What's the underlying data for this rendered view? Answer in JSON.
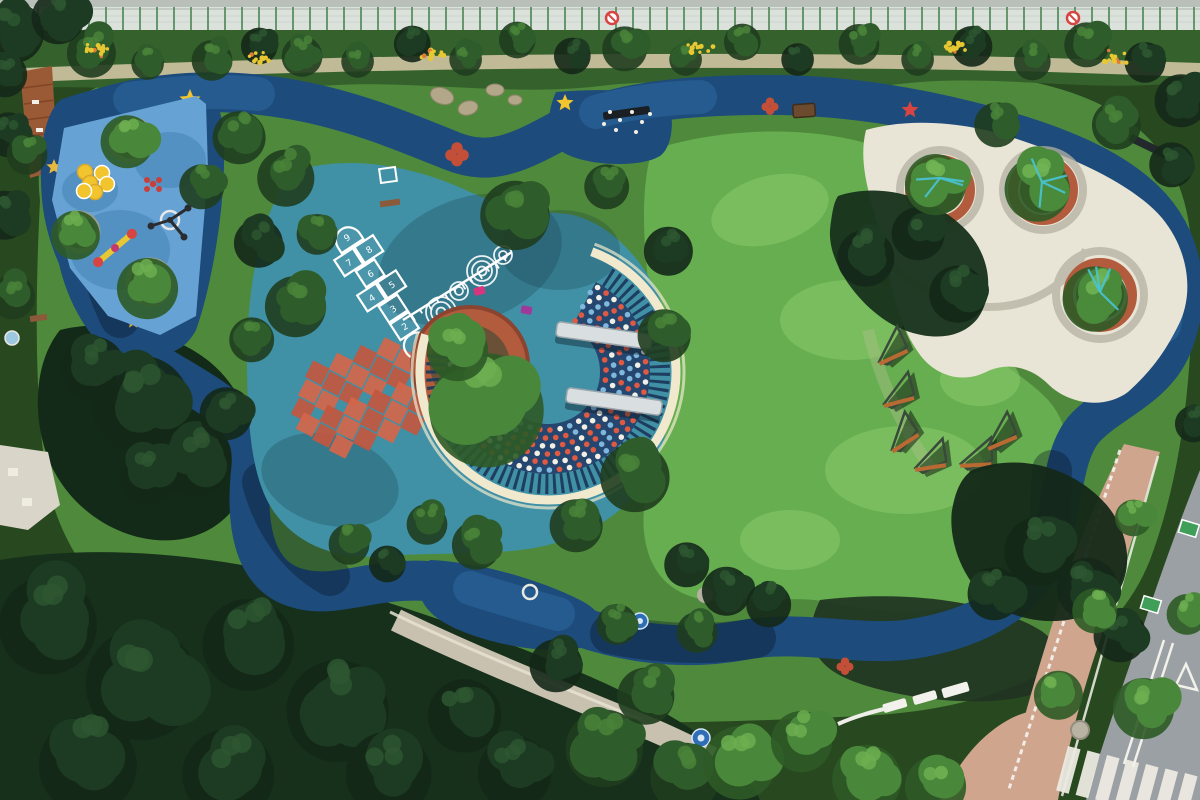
{
  "scene": {
    "title": "Aerial Park View",
    "description": "Top-down drone photograph of a community pocket park: a dark-blue rubber jogging loop winds around a light-blue toddler playground with yellow discs and stars, a teal play plaza with a numbered hopscotch, growth ruler, orange checkerboard and a crescent pergola with confetti dots and two steel benches, a bright lawn with rust zigzag climbers, and a white plaza with round brick tree planters. Dense tree canopy borders the park, a street with zebra crossing crosses the lower-right corner and a construction fence runs along the top."
  },
  "colors": {
    "track": "#1d4b7b",
    "trackLight": "#2f6ca6",
    "navy": "#25476f",
    "playBlue": "#66a3d4",
    "playShadow": "#3f7cb0",
    "teal": "#4090a6",
    "tealShadow": "#2e7390",
    "lawn": "#66ae4f",
    "lawnLight": "#8bcb6b",
    "grass": "#4f8a3c",
    "shrub": "#35622c",
    "parkBase": "#4f8a3c",
    "cream": "#f0e9cd",
    "plaza": "#e9e5d6",
    "plazaBand": "#b6b2a2",
    "brick": "#b25c3d",
    "brickDark": "#8a4430",
    "soil": "#6a5036",
    "sidewalk": "#d0a58e",
    "stone": "#c8c1b0",
    "road": "#9ba0a4",
    "rust": "#b96a33",
    "yellow": "#f2c52e",
    "red": "#d64541",
    "magenta": "#d6367f",
    "tealPaint": "#49c4d6",
    "markGreen": "#3f9e57",
    "wood": "#9a5a36",
    "benchSteel": "#d9dee1",
    "binBrown": "#6b4a2e",
    "checkerA": "#d4664a",
    "checkerB": "#c2573f",
    "fenceLight": "#e3e7e3",
    "fencePost": "#5b8f63",
    "canopyDark": "#142818",
    "canopyMid": "#2f5c2b",
    "canopyBright": "#49873a"
  },
  "hopscotch": {
    "cells": [
      {
        "n": "1",
        "x": 0,
        "y": 62
      },
      {
        "n": "2",
        "x": 0,
        "y": 40
      },
      {
        "n": "3",
        "x": 0,
        "y": 19
      },
      {
        "n": "4",
        "x": -12,
        "y": -2
      },
      {
        "n": "5",
        "x": 12,
        "y": -2
      },
      {
        "n": "6",
        "x": 0,
        "y": -23
      },
      {
        "n": "7",
        "x": -12,
        "y": -44
      },
      {
        "n": "8",
        "x": 12,
        "y": -44
      },
      {
        "n": "9",
        "x": 0,
        "y": -66
      }
    ]
  },
  "decor": {
    "shades": {
      "dark": [
        "#142818",
        "#1d3a22",
        "#2d5630"
      ],
      "mid": [
        "#1f3d1e",
        "#2f5c2b",
        "#49823a"
      ],
      "bright": [
        "#2e5a26",
        "#49873a",
        "#6cae50"
      ],
      "planter": [
        "#2e5a26",
        "#4a8a3b",
        "#70b455"
      ]
    },
    "ruler": {
      "x1": 403,
      "y1": 320,
      "x2": 512,
      "y2": 252,
      "ticks": 12,
      "len": 7
    },
    "checker": {
      "cx": 365,
      "cy": 398,
      "rot": -18,
      "cell": 25,
      "rows": [
        4,
        5,
        6,
        6,
        5,
        4
      ]
    },
    "confetti": {
      "cx": 548,
      "cy": 372,
      "r0": 52,
      "r1": 102,
      "rings": 6,
      "a0": -62,
      "a1": 188,
      "spacing": 10,
      "dotColors": [
        "#e05a43",
        "#f2efe4",
        "#7fb7dd"
      ]
    },
    "slats": {
      "r": 112,
      "a0": -58,
      "a1": 190,
      "width": 20,
      "dash": "3 4.6"
    },
    "ribbon": {
      "r": 128,
      "a0": -70,
      "a1": 197,
      "width": 9,
      "outerR": 136
    },
    "fence": {
      "y": 7,
      "h": 23,
      "postGap": 17,
      "signs": [
        612,
        1073
      ]
    },
    "zebra": {
      "x": 1068,
      "y": 746,
      "stripes": 7,
      "stepX": 19.5,
      "stepY": 4.5,
      "w": 13,
      "h": 46,
      "rot": 15
    },
    "stars": [
      {
        "x": 190,
        "y": 100,
        "r": 11,
        "c": "#f2c52e"
      },
      {
        "x": 565,
        "y": 103,
        "r": 9,
        "c": "#f2c52e"
      },
      {
        "x": 54,
        "y": 167,
        "r": 8,
        "c": "#e8b93e"
      },
      {
        "x": 133,
        "y": 322,
        "r": 7,
        "c": "#cfa23a"
      },
      {
        "x": 910,
        "y": 110,
        "r": 9,
        "c": "#d64541"
      }
    ],
    "clovers": [
      {
        "x": 457,
        "y": 154,
        "r": 11
      },
      {
        "x": 770,
        "y": 106,
        "r": 8
      },
      {
        "x": 845,
        "y": 666,
        "r": 8
      }
    ],
    "discs": [
      [
        85,
        172
      ],
      [
        102,
        173
      ],
      [
        90,
        183
      ],
      [
        107,
        184
      ],
      [
        95,
        192
      ],
      [
        84,
        191
      ]
    ],
    "zigzags": [
      {
        "x": 878,
        "y": 356,
        "rot": -10
      },
      {
        "x": 884,
        "y": 398,
        "rot": 0
      },
      {
        "x": 890,
        "y": 444,
        "rot": -18
      },
      {
        "x": 916,
        "y": 462,
        "rot": 6
      },
      {
        "x": 962,
        "y": 458,
        "rot": 12
      },
      {
        "x": 987,
        "y": 441,
        "rot": -8
      }
    ],
    "flowers": [
      [
        95,
        50
      ],
      [
        262,
        58
      ],
      [
        432,
        55
      ],
      [
        700,
        47
      ],
      [
        952,
        48
      ],
      [
        1115,
        58
      ]
    ],
    "trees": [
      [
        95,
        48,
        24,
        "mid"
      ],
      [
        150,
        60,
        16,
        "mid"
      ],
      [
        215,
        56,
        20,
        "mid"
      ],
      [
        262,
        42,
        18,
        "dark"
      ],
      [
        305,
        52,
        20,
        "mid"
      ],
      [
        360,
        58,
        16,
        "mid"
      ],
      [
        415,
        40,
        18,
        "dark"
      ],
      [
        468,
        56,
        16,
        "mid"
      ],
      [
        520,
        36,
        18,
        "mid"
      ],
      [
        575,
        52,
        18,
        "dark"
      ],
      [
        628,
        44,
        22,
        "mid"
      ],
      [
        688,
        56,
        16,
        "mid"
      ],
      [
        745,
        38,
        18,
        "mid"
      ],
      [
        800,
        56,
        16,
        "dark"
      ],
      [
        862,
        40,
        20,
        "mid"
      ],
      [
        920,
        56,
        16,
        "mid"
      ],
      [
        975,
        42,
        20,
        "dark"
      ],
      [
        1035,
        58,
        18,
        "mid"
      ],
      [
        1090,
        40,
        22,
        "mid"
      ],
      [
        1148,
        58,
        20,
        "dark"
      ],
      [
        1185,
        95,
        26,
        "dark"
      ],
      [
        18,
        26,
        30,
        "dark"
      ],
      [
        62,
        12,
        26,
        "dark"
      ],
      [
        8,
        70,
        22,
        "dark"
      ],
      [
        12,
        130,
        22,
        "dark"
      ],
      [
        8,
        210,
        24,
        "dark"
      ],
      [
        16,
        292,
        22,
        "mid"
      ],
      [
        30,
        150,
        20,
        "mid"
      ],
      [
        131,
        136,
        26,
        "bright"
      ],
      [
        79,
        230,
        24,
        "bright"
      ],
      [
        152,
        282,
        30,
        "bright"
      ],
      [
        205,
        182,
        22,
        "mid"
      ],
      [
        243,
        132,
        26,
        "mid"
      ],
      [
        290,
        172,
        28,
        "mid"
      ],
      [
        262,
        238,
        24,
        "dark"
      ],
      [
        300,
        300,
        30,
        "mid"
      ],
      [
        255,
        335,
        22,
        "mid"
      ],
      [
        320,
        230,
        20,
        "mid"
      ],
      [
        520,
        208,
        34,
        "mid"
      ],
      [
        610,
        182,
        22,
        "mid"
      ],
      [
        672,
        246,
        24,
        "dark"
      ],
      [
        668,
        330,
        26,
        "mid"
      ],
      [
        640,
        470,
        34,
        "mid"
      ],
      [
        580,
        520,
        26,
        "mid"
      ],
      [
        480,
        540,
        24,
        "mid"
      ],
      [
        430,
        520,
        20,
        "mid"
      ],
      [
        495,
        398,
        56,
        "bright"
      ],
      [
        462,
        344,
        30,
        "bright"
      ],
      [
        148,
        394,
        48,
        "dark"
      ],
      [
        98,
        362,
        32,
        "dark"
      ],
      [
        200,
        452,
        36,
        "dark"
      ],
      [
        152,
        470,
        28,
        "dark"
      ],
      [
        230,
        408,
        26,
        "dark"
      ],
      [
        352,
        540,
        20,
        "mid"
      ],
      [
        390,
        560,
        18,
        "dark"
      ],
      [
        690,
        560,
        22,
        "dark"
      ],
      [
        730,
        586,
        24,
        "dark"
      ],
      [
        772,
        600,
        22,
        "dark"
      ],
      [
        700,
        628,
        20,
        "mid"
      ],
      [
        998,
        588,
        26,
        "dark"
      ],
      [
        1044,
        544,
        34,
        "dark"
      ],
      [
        1092,
        582,
        30,
        "dark"
      ],
      [
        1124,
        630,
        26,
        "dark"
      ],
      [
        870,
        252,
        28,
        "dark"
      ],
      [
        922,
        228,
        26,
        "dark"
      ],
      [
        962,
        288,
        28,
        "dark"
      ],
      [
        940,
        178,
        30,
        "planter"
      ],
      [
        1042,
        182,
        32,
        "planter"
      ],
      [
        1100,
        292,
        32,
        "planter"
      ],
      [
        1000,
        120,
        22,
        "mid"
      ],
      [
        1120,
        120,
        24,
        "mid"
      ],
      [
        1175,
        160,
        22,
        "dark"
      ],
      [
        1196,
        420,
        18,
        "dark"
      ],
      [
        55,
        615,
        48,
        "dark"
      ],
      [
        150,
        672,
        55,
        "dark"
      ],
      [
        255,
        635,
        45,
        "dark"
      ],
      [
        345,
        700,
        50,
        "dark"
      ],
      [
        95,
        755,
        48,
        "dark"
      ],
      [
        235,
        765,
        45,
        "dark"
      ],
      [
        395,
        765,
        42,
        "dark"
      ],
      [
        470,
        708,
        36,
        "dark"
      ],
      [
        520,
        765,
        36,
        "dark"
      ],
      [
        610,
        740,
        38,
        "mid"
      ],
      [
        650,
        690,
        28,
        "mid"
      ],
      [
        690,
        770,
        34,
        "mid"
      ],
      [
        745,
        755,
        36,
        "bright"
      ],
      [
        806,
        735,
        30,
        "bright"
      ],
      [
        872,
        772,
        34,
        "bright"
      ],
      [
        940,
        780,
        30,
        "bright"
      ],
      [
        560,
        660,
        26,
        "dark"
      ],
      [
        620,
        620,
        20,
        "mid"
      ],
      [
        1136,
        514,
        18,
        "bright"
      ],
      [
        1098,
        606,
        22,
        "bright"
      ],
      [
        1148,
        702,
        30,
        "bright"
      ],
      [
        1062,
        690,
        24,
        "bright"
      ],
      [
        1190,
        610,
        20,
        "bright"
      ]
    ]
  }
}
